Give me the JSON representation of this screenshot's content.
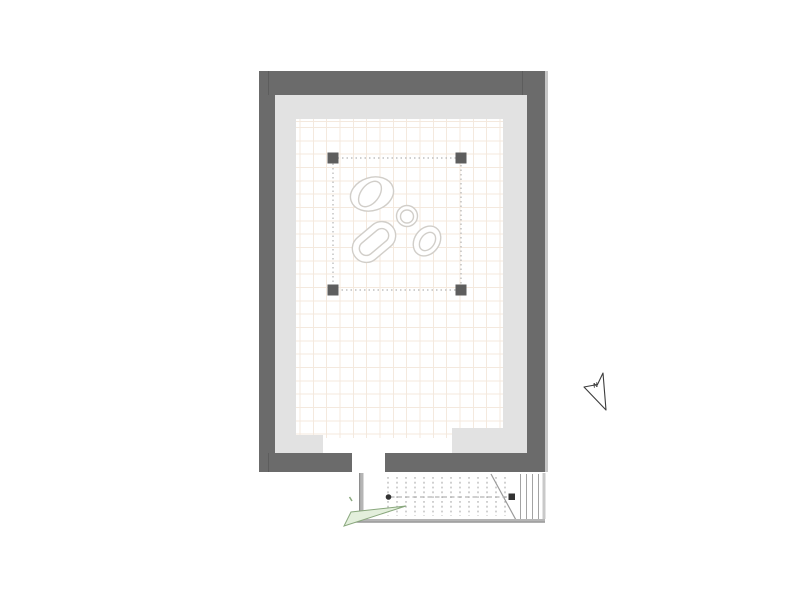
{
  "north_arrow": {
    "label": "N"
  },
  "colors": {
    "wall": "#6b6b6b",
    "wall-edge": "#c6c6c6",
    "margin": "#e2e2e2",
    "floor": "#ffffff",
    "grid-line": "#f4e9de",
    "blob-outline": "#d1cec9",
    "selection": "#b5b5b5",
    "handle": "#5e5e5e",
    "stair-line": "#a0a0a0",
    "stair-dash": "#b3b3b3",
    "stair-marker": "#333333",
    "stair-wall": "#b5b5b5",
    "stair-wall-edge": "#8e8e8e",
    "door-fill": "#e3efdc",
    "door-stroke": "#8aa87e",
    "north-stroke": "#3c3c3c"
  }
}
